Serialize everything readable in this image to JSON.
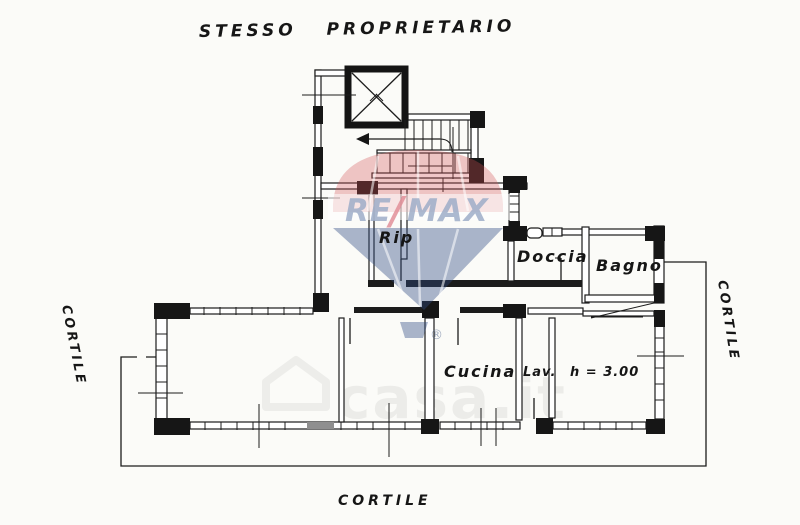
{
  "title": "STESSO PROPRIETARIO",
  "courtyard_labels": {
    "left": "CORTILE",
    "right": "CORTILE",
    "bottom": "CORTILE"
  },
  "rooms": {
    "rip": "Rip",
    "doccia": "Doccia",
    "bagno": "Bagno",
    "cucina": "Cucina",
    "lav": "Lav.",
    "height_note": "h = 3.00"
  },
  "watermarks": {
    "remax": {
      "re": "RE",
      "slash": "/",
      "max": "MAX",
      "registered": "®",
      "balloon_red": "#d55054",
      "balloon_blue": "#2f4a83"
    },
    "casait": {
      "text": "casa.it"
    }
  },
  "plan": {
    "ink": "#1c1c1c",
    "paper": "#fbfbf8",
    "window_gray": "#8f8f8f"
  }
}
